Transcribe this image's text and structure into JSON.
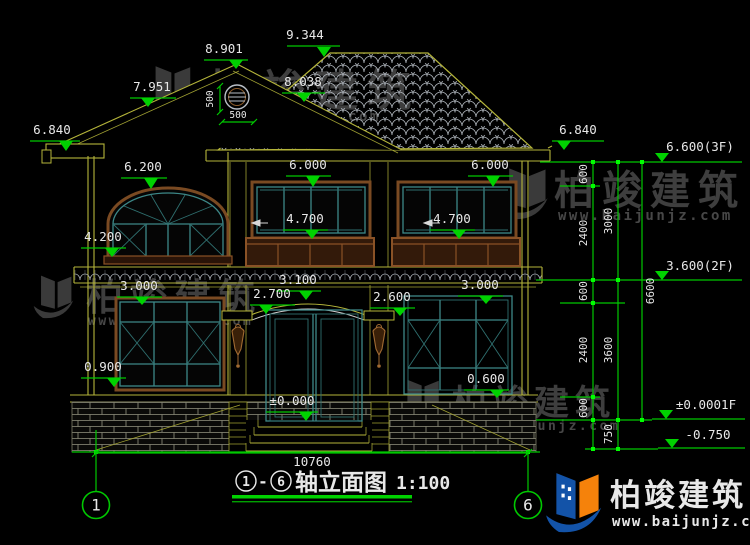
{
  "watermark": {
    "brand": "柏竣建筑",
    "url": "www.baijunjz.com"
  },
  "title_bar": {
    "axis_start": "1",
    "separator": "-",
    "axis_end": "6",
    "name": "轴立面图",
    "scale": "1:100"
  },
  "axes": {
    "left": "1",
    "right": "6"
  },
  "dims": {
    "ridge": "9.344",
    "gable_peak": "8.901",
    "gable_slope_left": "7.951",
    "gable_slope_right": "8.038",
    "vent_width": "500",
    "vent_height": "500",
    "eave_left": "6.840",
    "eave_right": "6.840",
    "arch_window_top": "6.200",
    "arch_window_sill": "4.200",
    "window2f_left_top": "6.000",
    "window2f_right_top": "6.000",
    "railing_left": "4.700",
    "railing_right": "4.700",
    "door_arch_top": "3.100",
    "door_spring_left": "2.700",
    "door_spring_right": "2.600",
    "window1f_left_top": "3.000",
    "window1f_right_top": "3.000",
    "window1f_left_sill": "0.900",
    "window1f_right_sill": "0.600",
    "floor_level": "±0.000",
    "total_width": "10760"
  },
  "levels_right": {
    "floor3": "6.600(3F)",
    "floor2": "3.600(2F)",
    "floor1": "±0.0001F",
    "ground": "-0.750"
  },
  "chain_a": [
    "600",
    "2400",
    "600",
    "2400",
    "600"
  ],
  "chain_b": [
    "3000",
    "3600",
    "750"
  ],
  "chain_c": [
    "6600"
  ]
}
